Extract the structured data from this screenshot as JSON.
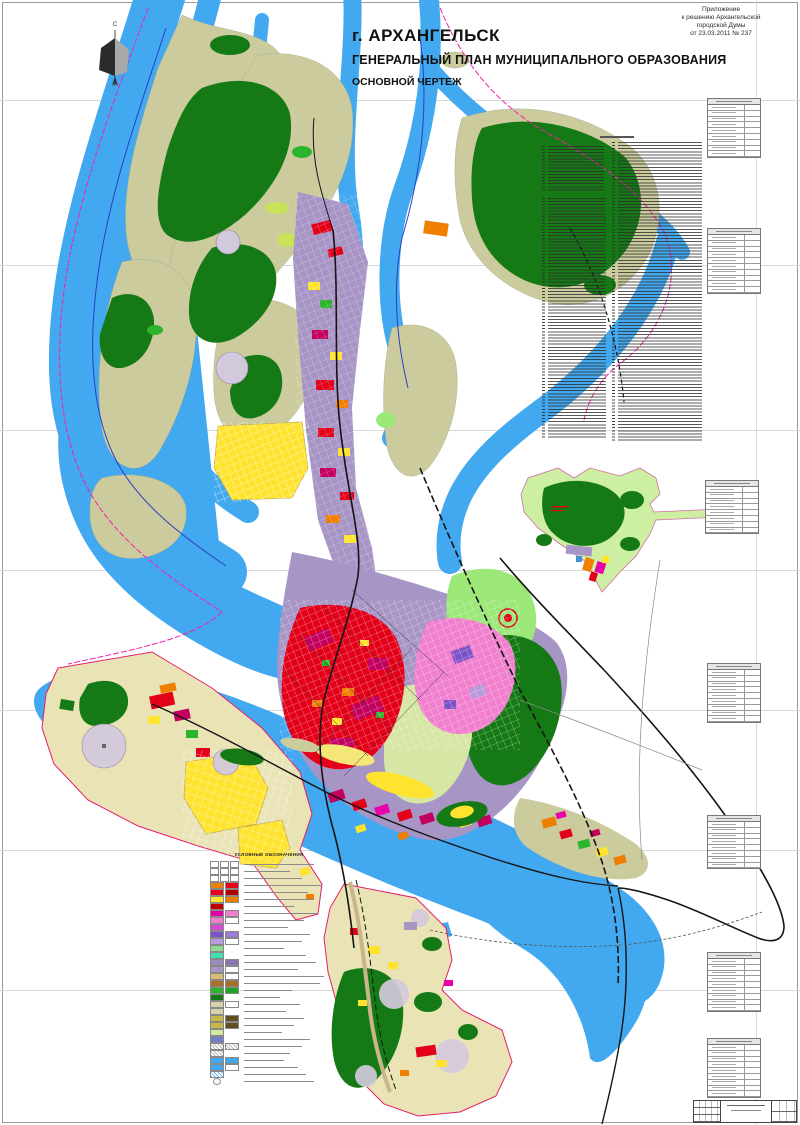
{
  "annotation": {
    "lines": [
      "Приложение",
      "к решению Архангельской",
      "городской Думы",
      "от 23.03.2011 № 237"
    ]
  },
  "title": {
    "line1": "г. АРХАНГЕЛЬСК",
    "line2": "ГЕНЕРАЛЬНЫЙ ПЛАН МУНИЦИПАЛЬНОГО ОБРАЗОВАНИЯ",
    "line3": "ОСНОВНОЙ ЧЕРТЕЖ"
  },
  "compass": {
    "north_label": "С"
  },
  "legend": {
    "title": "УСЛОВНЫЕ ОБОЗНАЧЕНИЯ",
    "rows": [
      {
        "cells": [
          "#FFFFFF",
          "#FFFFFF",
          "#FFFFFF"
        ],
        "lw": 70
      },
      {
        "cells": [
          "#FFFFFF",
          "#FFFFFF",
          "#FFFFFF"
        ],
        "lw": 46
      },
      {
        "cells": [
          "#FFFFFF",
          "#FFFFFF",
          "#FFFFFF"
        ],
        "lw": 58
      },
      {
        "cells": [
          "#F07E00",
          "#E30018"
        ],
        "lw": 78
      },
      {
        "cells": [
          "#E30018",
          "#B00000"
        ],
        "lw": 64
      },
      {
        "cells": [
          "#FFE32E",
          "#F07E00"
        ],
        "lw": 70
      },
      {
        "cells": [
          "#C00000"
        ],
        "lw": 50
      },
      {
        "cells": [
          "#E800A8",
          "#F07FCE"
        ],
        "lw": 74
      },
      {
        "cells": [
          "#F07FCE",
          "#FFFFFF"
        ],
        "lw": 60
      },
      {
        "cells": [
          "#D24BD2"
        ],
        "lw": 44
      },
      {
        "cells": [
          "#7B52C8",
          "#9E7BD8"
        ],
        "lw": 66
      },
      {
        "cells": [
          "#B79ADF",
          "#FFFFFF"
        ],
        "lw": 58
      },
      {
        "cells": [
          "#8FD98F"
        ],
        "lw": 40
      },
      {
        "cells": [
          "#3FE0B0"
        ],
        "lw": 62
      },
      {
        "cells": [
          "#9C8BBE",
          "#8A76B0"
        ],
        "lw": 72
      },
      {
        "cells": [
          "#A795C5",
          "#FFFFFF"
        ],
        "lw": 54
      },
      {
        "cells": [
          "#D9BC7A",
          "#FFFFFF"
        ],
        "lw": 80
      },
      {
        "cells": [
          "#A96F28",
          "#A96F28"
        ],
        "lw": 76
      },
      {
        "cells": [
          "#2DB32D",
          "#23A323"
        ],
        "lw": 48
      },
      {
        "cells": [
          "#157A15"
        ],
        "lw": 36
      },
      {
        "cells": [
          "#D8D2A8",
          "#FFFFFF"
        ],
        "lw": 56
      },
      {
        "cells": [
          "#D8D2A8"
        ],
        "lw": 42
      },
      {
        "cells": [
          "#C8B84A",
          "#605020"
        ],
        "lw": 60
      },
      {
        "cells": [
          "#C8B84A",
          "#605020"
        ],
        "lw": 50
      },
      {
        "cells": [
          "#D6E6A4"
        ],
        "lw": 38
      },
      {
        "cells": [
          "#7080C8"
        ],
        "lw": 66
      },
      {
        "cells": [
          "#FFFFFF",
          "#FFFFFF"
        ],
        "pattern": "hatch",
        "lw": 58
      },
      {
        "cells": [
          "#FFFFFF"
        ],
        "pattern": "hatch",
        "lw": 46
      },
      {
        "cells": [
          "#42A9F0",
          "#42A9F0"
        ],
        "lw": 40
      },
      {
        "cells": [
          "#42A9F0",
          "#FFFFFF"
        ],
        "lw": 54
      },
      {
        "cells": [
          "#FFFFFF"
        ],
        "pattern": "bluehatch",
        "lw": 62
      },
      {
        "cells": [
          "#FFFFFF"
        ],
        "pattern": "circle",
        "lw": 70
      }
    ]
  },
  "object_list": {
    "columns": 2,
    "rows_per_column": [
      92,
      96
    ]
  },
  "side_tables": {
    "rows_per_table": [
      9,
      10,
      8,
      9,
      8,
      9,
      9
    ]
  },
  "palette": {
    "water": "#42A9F0",
    "land_olive": "#CBCB9E",
    "land_lightgreen": "#CDEFA3",
    "land_beige": "#E9E3B6",
    "forest": "#157A15",
    "forest_bright": "#2DB32D",
    "urban_mixed": "#A795C5",
    "residential_red": "#E30018",
    "residential_crimson": "#C4005E",
    "residential_magenta": "#E800A8",
    "residential_pink": "#F07FCE",
    "public_purple": "#7B52C8",
    "industrial_orange": "#F07E00",
    "lowrise_yellow": "#FFE32E",
    "garden_field": "#D6E6A4",
    "park_green": "#9BE878",
    "sanitary_circle_gray": "#D2C9DC",
    "boundary_magenta": "#F520A8",
    "boundary_blue": "#2A3FC4",
    "boundary_crimson": "#E3206A",
    "road_black": "#141414"
  }
}
